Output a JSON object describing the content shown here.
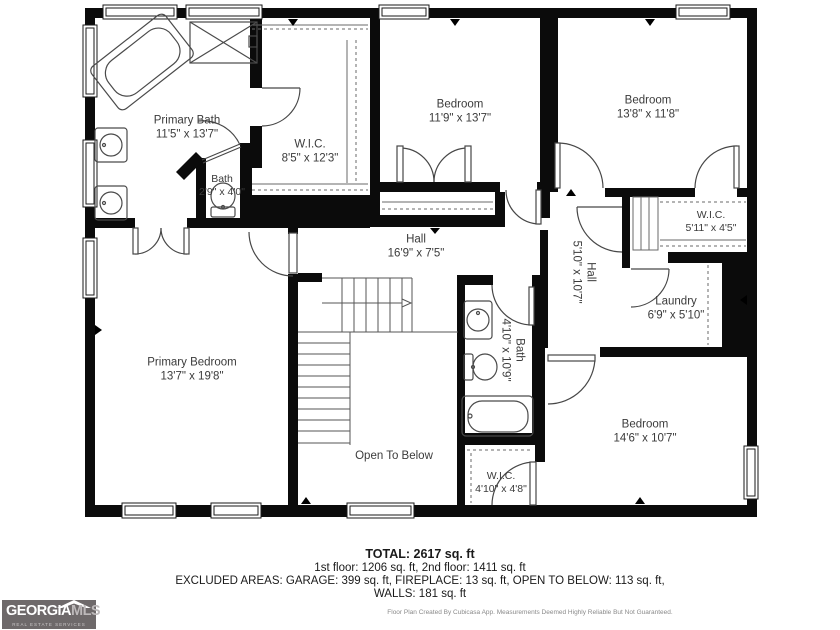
{
  "plan": {
    "rooms": [
      {
        "name": "Primary Bath",
        "dims": "11'5\" x 13'7\""
      },
      {
        "name": "W.I.C.",
        "dims": "8'5\" x 12'3\""
      },
      {
        "name": "Bath",
        "dims": "2'9\" x 4'0\""
      },
      {
        "name": "Bedroom",
        "dims": "11'9\" x 13'7\""
      },
      {
        "name": "Bedroom",
        "dims": "13'8\" x 11'8\""
      },
      {
        "name": "W.I.C.",
        "dims": "5'11\" x 4'5\""
      },
      {
        "name": "Hall",
        "dims": "5'10\" x 10'7\""
      },
      {
        "name": "Laundry",
        "dims": "6'9\" x 5'10\""
      },
      {
        "name": "Hall",
        "dims": "16'9\" x 7'5\""
      },
      {
        "name": "Bath",
        "dims": "4'10\" x 10'9\""
      },
      {
        "name": "Primary Bedroom",
        "dims": "13'7\" x 19'8\""
      },
      {
        "name": "Open To Below",
        "dims": ""
      },
      {
        "name": "Bedroom",
        "dims": "14'6\" x 10'7\""
      },
      {
        "name": "W.I.C.",
        "dims": "4'10\" x 4'8\""
      }
    ],
    "summary": {
      "total": "TOTAL: 2617 sq. ft",
      "floors": "1st floor: 1206 sq. ft, 2nd floor: 1411 sq. ft",
      "excluded": "EXCLUDED AREAS: GARAGE: 399 sq. ft, FIREPLACE: 13 sq. ft, OPEN TO BELOW: 113 sq. ft,",
      "walls": "WALLS: 181 sq. ft"
    },
    "disclaimer": "Floor Plan Created By Cubicasa App. Measurements Deemed Highly Reliable But Not Guaranteed.",
    "logo": {
      "brand_primary": "GEORGIA",
      "brand_secondary": "MLS",
      "tagline": "REAL ESTATE SERVICES"
    },
    "colors": {
      "wall": "#0b0b0b",
      "background": "#ffffff",
      "label_text": "#3b3b3b",
      "logo_background": "#6e696a"
    }
  }
}
